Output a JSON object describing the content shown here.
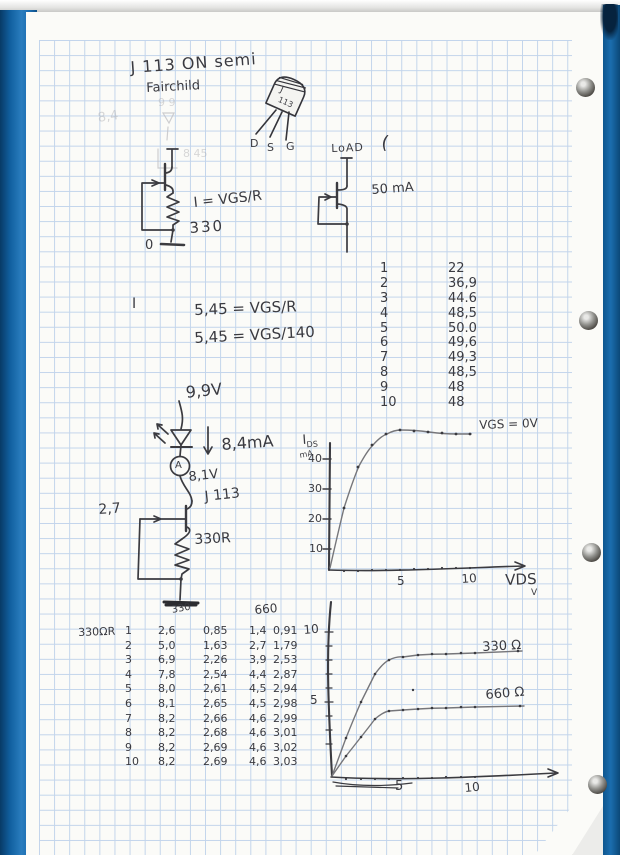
{
  "notes": {
    "title_line1": "J 113 ON semi",
    "title_line2": "Fairchild",
    "faint_a": "8,4",
    "faint_b": "9 9",
    "faint_c": "8 45",
    "lone_mark": "I"
  },
  "package_sketch": {
    "line1": "J",
    "line2": "113",
    "pins": [
      "D",
      "S",
      "G"
    ]
  },
  "circuit_selfbias": {
    "formula": "I = VGS/R",
    "resistor": "330",
    "ground_label": "0"
  },
  "circuit_load": {
    "title": "LoAD",
    "paren": "(",
    "current": "50 mA"
  },
  "equations": {
    "eq1": "5,45 = VGS/R",
    "eq2": "5,45 = VGS/140"
  },
  "table_idss": {
    "rows": [
      [
        "1",
        "22"
      ],
      [
        "2",
        "36,9"
      ],
      [
        "3",
        "44.6"
      ],
      [
        "4",
        "48,5"
      ],
      [
        "5",
        "50.0"
      ],
      [
        "6",
        "49,6"
      ],
      [
        "7",
        "49,3"
      ],
      [
        "8",
        "48,5"
      ],
      [
        "9",
        "48"
      ],
      [
        "10",
        "48"
      ]
    ]
  },
  "circuit_led": {
    "supply": "9,9V",
    "current": "8,4mA",
    "mid_voltage": "8,1V",
    "transistor": "J 113",
    "gate_v": "2,7",
    "resistor": "330R",
    "ammeter": "A"
  },
  "graph_top": {
    "y_axis_main": "I",
    "y_axis_sub": "DS",
    "y_unit": "mA",
    "y_ticks": [
      "40",
      "30",
      "20",
      "10"
    ],
    "x_ticks": [
      "5",
      "10"
    ],
    "x_axis": "VDS",
    "x_axis_unit": "V",
    "curve_label": "VGS = 0V"
  },
  "table_r": {
    "row_label": "330ΩR",
    "col_330": "330",
    "col_660": "660",
    "rows": [
      [
        "1",
        "2,6",
        "0,85",
        "1,4",
        "0,91"
      ],
      [
        "2",
        "5,0",
        "1,63",
        "2,7",
        "1,79"
      ],
      [
        "3",
        "6,9",
        "2,26",
        "3,9",
        "2,53"
      ],
      [
        "4",
        "7,8",
        "2,54",
        "4,4",
        "2,87"
      ],
      [
        "5",
        "8,0",
        "2,61",
        "4,5",
        "2,94"
      ],
      [
        "6",
        "8,1",
        "2,65",
        "4,5",
        "2,98"
      ],
      [
        "7",
        "8,2",
        "2,66",
        "4,6",
        "2,99"
      ],
      [
        "8",
        "8,2",
        "2,68",
        "4,6",
        "3,01"
      ],
      [
        "9",
        "8,2",
        "2,69",
        "4,6",
        "3,02"
      ],
      [
        "10",
        "8,2",
        "2,69",
        "4,6",
        "3,03"
      ]
    ]
  },
  "graph_bottom": {
    "y_ticks": [
      "10",
      "5"
    ],
    "x_ticks": [
      "5",
      "10"
    ],
    "label_330": "330 Ω",
    "label_660": "660 Ω"
  },
  "chart_data": [
    {
      "type": "line",
      "title": "JFET output curve, VGS = 0V",
      "x": [
        1,
        2,
        3,
        4,
        5,
        6,
        7,
        8,
        9,
        10
      ],
      "series": [
        {
          "name": "VGS = 0V",
          "values": [
            22,
            36.9,
            44.6,
            48.5,
            50.0,
            49.6,
            49.3,
            48.5,
            48,
            48
          ]
        }
      ],
      "xlabel": "VDS (V)",
      "ylabel": "IDS (mA)",
      "x_ticks": [
        5,
        10
      ],
      "y_ticks": [
        10,
        20,
        30,
        40
      ],
      "grid": false,
      "legend_position": "right-of-curve"
    },
    {
      "type": "line",
      "title": "Self-bias drain current, source resistor 330Ω vs 660Ω",
      "x": [
        1,
        2,
        3,
        4,
        5,
        6,
        7,
        8,
        9,
        10
      ],
      "series": [
        {
          "name": "330 Ω",
          "values": [
            2.6,
            5.0,
            6.9,
            7.8,
            8.0,
            8.1,
            8.2,
            8.2,
            8.2,
            8.2
          ]
        },
        {
          "name": "660 Ω",
          "values": [
            1.4,
            2.7,
            3.9,
            4.4,
            4.5,
            4.5,
            4.6,
            4.6,
            4.6,
            4.6
          ]
        }
      ],
      "xlabel": "VDS (V)",
      "ylabel": "IDS (mA)",
      "x_ticks": [
        5,
        10
      ],
      "y_ticks": [
        5,
        10
      ],
      "grid": false,
      "legend_position": "right-of-curve"
    }
  ]
}
